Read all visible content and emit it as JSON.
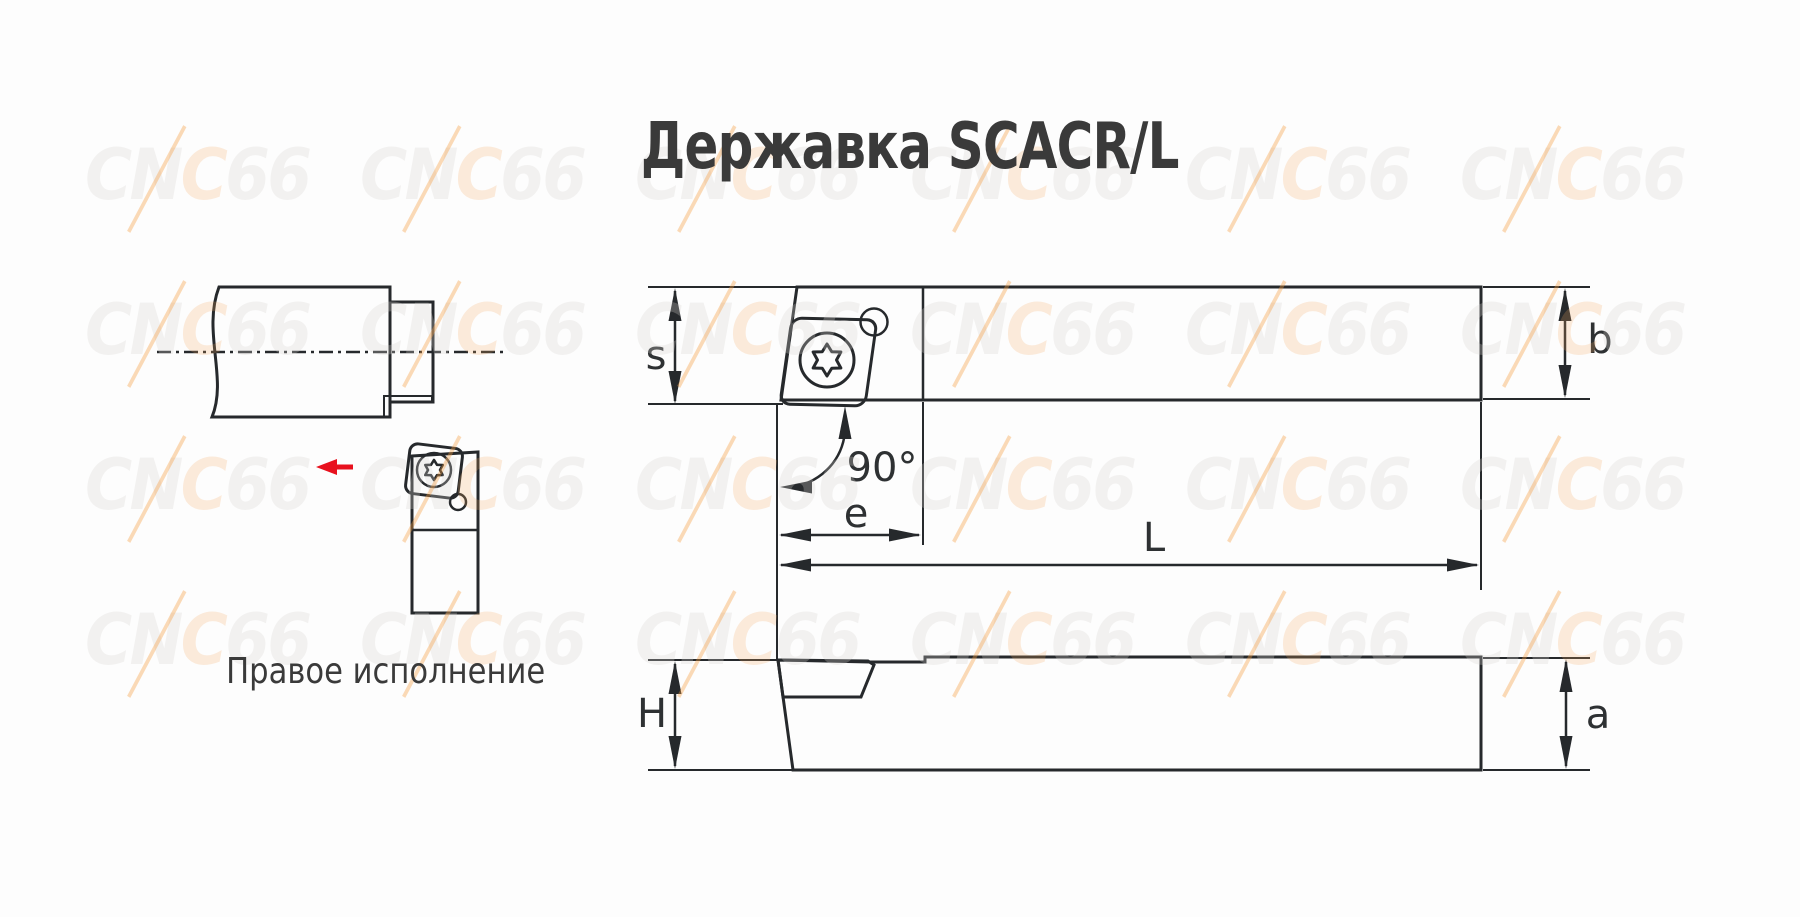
{
  "title": "Державка SCACR/L",
  "illustration": {
    "caption": "Правое исполнение",
    "colors": {
      "workpiece_blue": "#00a1e3",
      "machined_orange": "#ee8c11",
      "holder_gray": "#b6c0c9",
      "insert_yellow": "#ffe603",
      "feed_arrow_red": "#e8111e"
    }
  },
  "drawing": {
    "colors": {
      "shank_body": "#b9cdd9",
      "insert_yellow": "#ffe603",
      "line": "#26292c"
    },
    "labels": {
      "insert_thickness": "s",
      "lead_angle": "90°",
      "head_length": "e",
      "overall_length": "L",
      "shank_width": "b",
      "shank_height": "H",
      "tip_height": "a"
    }
  },
  "watermark": {
    "text": "CNC66",
    "part_gray_1": "CN",
    "part_orange": "C",
    "part_gray_2": "66"
  }
}
